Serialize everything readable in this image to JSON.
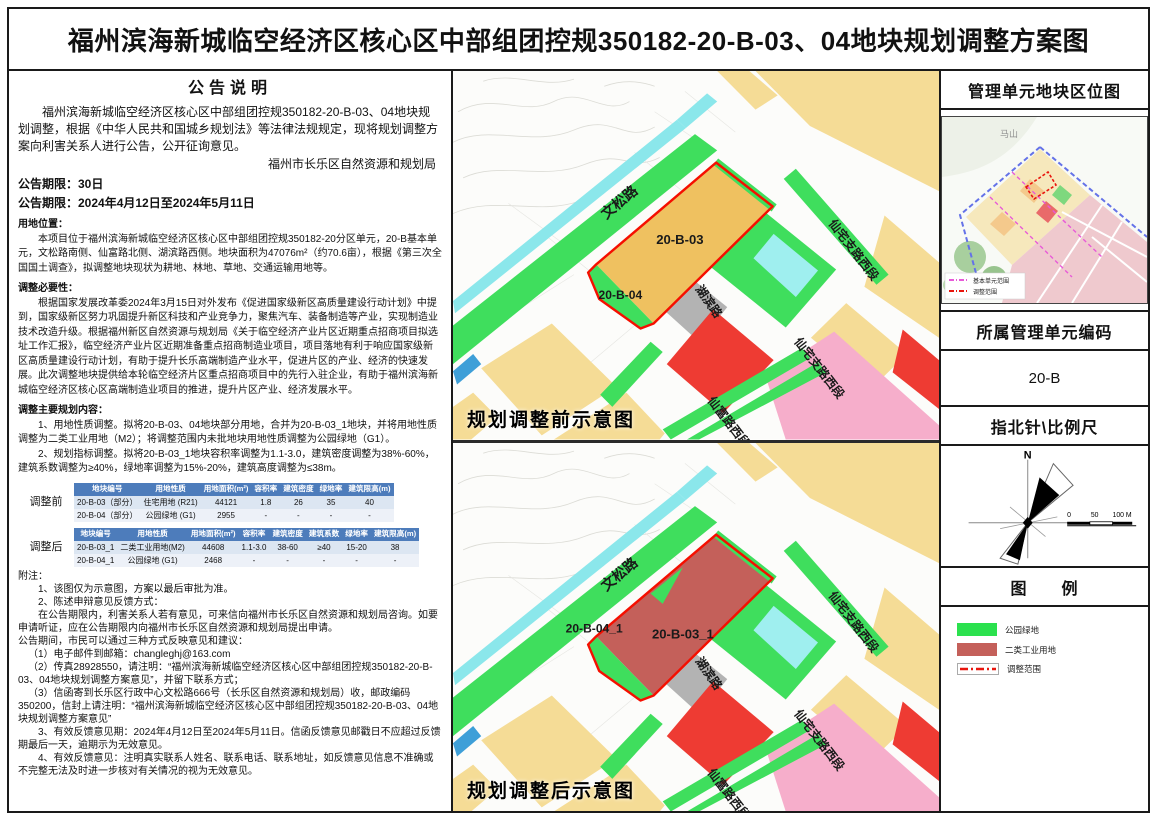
{
  "title": "福州滨海新城临空经济区核心区中部组团控规350182-20-B-03、04地块规划调整方案图",
  "notice": {
    "heading": "公告说明",
    "intro": "福州滨海新城临空经济区核心区中部组团控规350182-20-B-03、04地块规划调整，根据《中华人民共和国城乡规划法》等法律法规规定，现将规划调整方案向利害关系人进行公告，公开征询意见。",
    "agency": "福州市长乐区自然资源和规划局",
    "period_days": "公告期限：30日",
    "period_dates": "公告期限：2024年4月12日至2024年5月11日",
    "location_heading": "用地位置：",
    "location_text": "本项目位于福州滨海新城临空经济区核心区中部组团控规350182-20分区单元，20-B基本单元，文松路南侧、仙富路北侧、湖滨路西侧。地块面积为47076m²（约70.6亩），根据《第三次全国国土调查》，拟调整地块现状为耕地、林地、草地、交通运输用地等。",
    "necessity_heading": "调整必要性：",
    "necessity_text": "根据国家发展改革委2024年3月15日对外发布《促进国家级新区高质量建设行动计划》中提到，国家级新区努力巩固提升新区科技和产业竞争力，聚焦汽车、装备制造等产业，实现制造业技术改造升级。根据福州新区自然资源与规划局《关于临空经济产业片区近期重点招商项目拟选址工作汇报》，临空经济产业片区近期准备重点招商制造业项目，项目落地有利于响应国家级新区高质量建设行动计划，有助于提升长乐高端制造产业水平，促进片区的产业、经济的快速发展。此次调整地块提供给本轮临空经济片区重点招商项目中的先行入驻企业，有助于福州滨海新城临空经济区核心区高端制造业项目的推进，提升片区产业、经济发展水平。",
    "content_heading": "调整主要规划内容：",
    "content_item1": "1、用地性质调整。拟将20-B-03、04地块部分用地，合并为20-B-03_1地块，并将用地性质调整为二类工业用地（M2）；将调整范围内未批地块用地性质调整为公园绿地（G1）。",
    "content_item2": "2、规划指标调整。拟将20-B-03_1地块容积率调整为1.1-3.0，建筑密度调整为38%-60%，建筑系数调整为≥40%，绿地率调整为15%-20%，建筑高度调整为≤38m。",
    "notes_heading": "附注：",
    "notes": [
      "1、该图仅为示意图，方案以最后审批为准。",
      "2、陈述申辩意见反馈方式：",
      "在公告期限内，利害关系人若有意见，可来信向福州市长乐区自然资源和规划局咨询。如要申请听证，应在公告期限内向福州市长乐区自然资源和规划局提出申请。",
      "公告期间，市民可以通过三种方式反映意见和建议：",
      "（1）电子邮件到邮箱：changleghj@163.com",
      "（2）传真28928550，请注明：“福州滨海新城临空经济区核心区中部组团控规350182-20-B-03、04地块规划调整方案意见”，并留下联系方式；",
      "（3）信函寄到长乐区行政中心文松路666号（长乐区自然资源和规划局）收，邮政编码350200，信封上请注明：“福州滨海新城临空经济区核心区中部组团控规350182-20-B-03、04地块规划调整方案意见”",
      "3、有效反馈意见期：2024年4月12日至2024年5月11日。信函反馈意见邮戳日不应超过反馈期最后一天，逾期示为无效意见。",
      "4、有效反馈意见：注明真实联系人姓名、联系电话、联系地址，如反馈意见信息不准确或不完整无法及时进一步核对有关情况的视为无效意见。"
    ]
  },
  "tables": {
    "before": {
      "label": "调整前",
      "headers": [
        "地块编号",
        "用地性质",
        "用地面积(m²)",
        "容积率",
        "建筑密度",
        "绿地率",
        "建筑限高(m)"
      ],
      "rows": [
        [
          "20-B-03（部分）",
          "住宅用地 (R21)",
          "44121",
          "1.8",
          "26",
          "35",
          "40"
        ],
        [
          "20-B-04（部分）",
          "公园绿地 (G1)",
          "2955",
          "-",
          "-",
          "-",
          "-"
        ]
      ]
    },
    "after": {
      "label": "调整后",
      "headers": [
        "地块编号",
        "用地性质",
        "用地面积(m²)",
        "容积率",
        "建筑密度",
        "建筑系数",
        "绿地率",
        "建筑限高(m)"
      ],
      "rows": [
        [
          "20-B-03_1",
          "二类工业用地(M2)",
          "44608",
          "1.1-3.0",
          "38-60",
          "≥40",
          "15-20",
          "38"
        ],
        [
          "20-B-04_1",
          "公园绿地 (G1)",
          "2468",
          "-",
          "-",
          "-",
          "-",
          "-"
        ]
      ]
    }
  },
  "maps": {
    "roads": {
      "wensong": "文松路",
      "hubin": "湖滨路",
      "xianzhai": "仙宅支路西段",
      "xianfu": "仙富路西段"
    },
    "before": {
      "caption": "规划调整前示意图",
      "label_03": "20-B-03",
      "label_04": "20-B-04"
    },
    "after": {
      "caption": "规划调整后示意图",
      "label_03": "20-B-03_1",
      "label_04": "20-B-04_1"
    }
  },
  "sidebar": {
    "location_map_heading": "管理单元地块区位图",
    "minimap": {
      "mountain_label": "马山",
      "legend": [
        {
          "label": "基本单元范围",
          "color": "#E85AD8"
        },
        {
          "label": "调整范围",
          "color": "#E8150D"
        }
      ]
    },
    "unit_heading": "所属管理单元编码",
    "unit_code": "20-B",
    "compass_heading": "指北针\\比例尺",
    "north_label": "N",
    "scale": [
      "0",
      "50",
      "100 M"
    ],
    "legend_heading": "图　　例",
    "legend": [
      {
        "label": "公园绿地",
        "color": "#2BE14E",
        "type": "swatch"
      },
      {
        "label": "二类工业用地",
        "color": "#C4605A",
        "type": "swatch"
      },
      {
        "label": "调整范围",
        "color": "#E8150D",
        "type": "dashed"
      }
    ]
  },
  "colors": {
    "table_header_blue": "#4D7CBB",
    "parcel_tan": "#F5DC96",
    "parcel_orange_residential": "#EFC160",
    "park_green": "#3FDE5D",
    "industry_maroon": "#C4605A",
    "commercial_red": "#EE3B33",
    "pink": "#F6AECB",
    "water_cyan": "#8BE7EB",
    "adjust_outline_red": "#F50F00"
  }
}
